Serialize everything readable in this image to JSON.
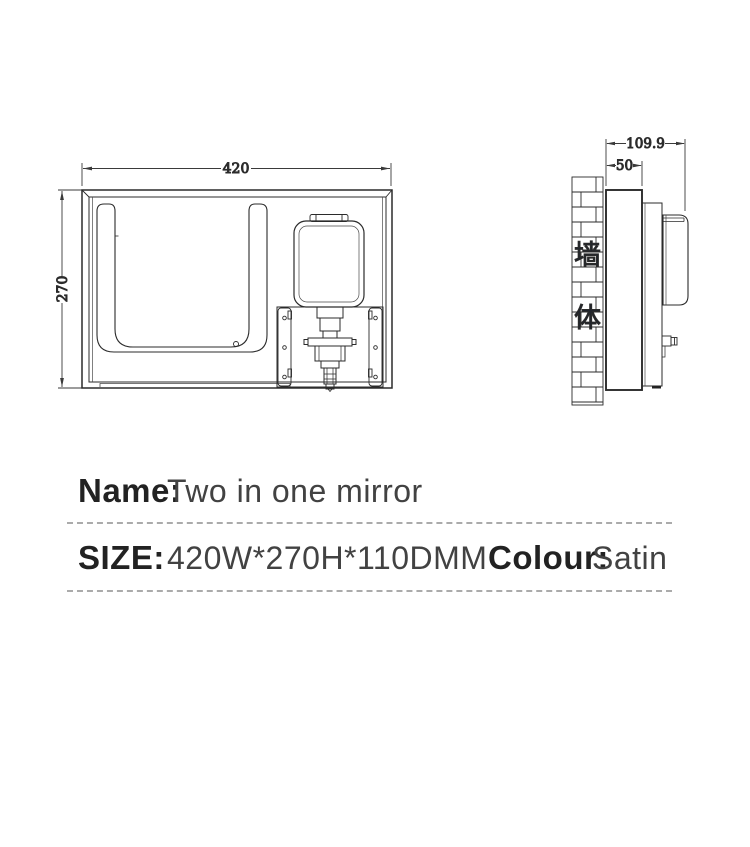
{
  "product": {
    "name_label": "Name:",
    "name_value": "Two in one mirror",
    "size_label": "SIZE:",
    "size_value": "420W*270H*110DMM",
    "colour_label": "Colour:",
    "colour_value": "Satin"
  },
  "front_view": {
    "width_dim": "420",
    "height_dim": "270"
  },
  "side_view": {
    "total_depth_dim": "109.9",
    "body_depth_dim": "50",
    "wall_chars": [
      "墙",
      "体"
    ]
  },
  "colors": {
    "line": "#2b2b2b",
    "dim_line": "#333333",
    "label_text": "#222222",
    "value_text": "#424242",
    "divider": "#ababab"
  }
}
